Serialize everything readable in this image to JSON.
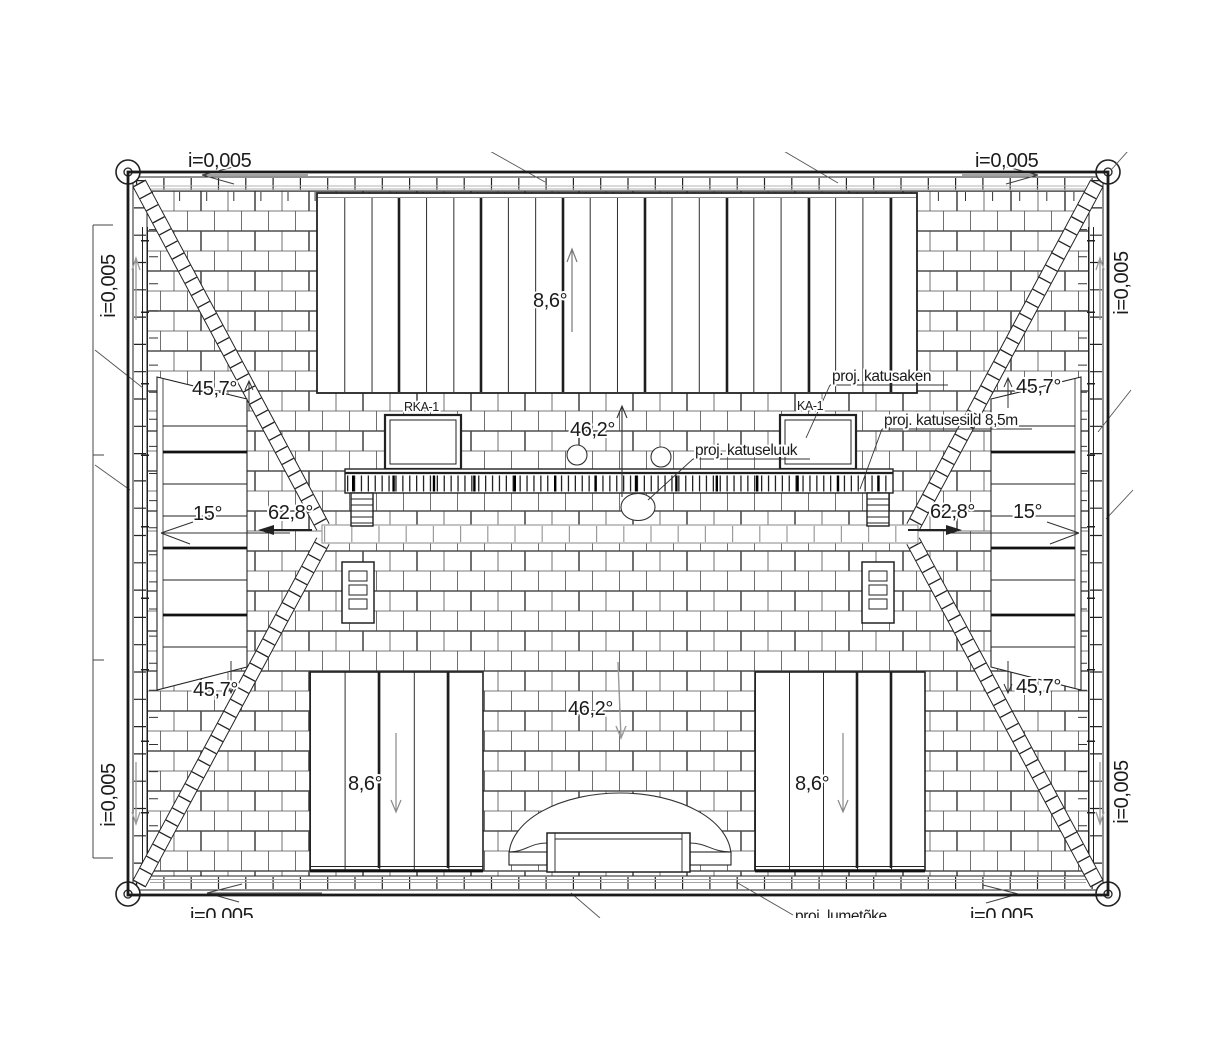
{
  "labels": {
    "eaves": {
      "top_left": "i=0,005",
      "top_right": "i=0,005",
      "bottom_left": "i=0,005",
      "bottom_right": "i=0,005",
      "left_top": "i=0,005",
      "left_bottom": "i=0,005",
      "right_top": "i=0,005",
      "right_bottom": "i=0,005"
    },
    "angles": {
      "main_slope_upper": "46,2°",
      "main_slope_lower": "46,2°",
      "top_dormer": "8,6°",
      "bottom_dormer_left": "8,6°",
      "bottom_dormer_right": "8,6°",
      "side_roof_left": "15°",
      "side_roof_right": "15°",
      "hip_slope_left": "62,8°",
      "hip_slope_right": "62,8°",
      "corner_top_left": "45,7°",
      "corner_top_right": "45,7°",
      "corner_bottom_left": "45,7°",
      "corner_bottom_right": "45,7°"
    },
    "skylight_left": "RKA-1",
    "skylight_right": "KA-1",
    "callouts": {
      "roof_window": "proj. katusaken",
      "roof_hatch": "proj. katuseluuk",
      "roof_bridge": "proj. katusesild 8,5m",
      "snow_guard": "proj. lumetõke"
    }
  },
  "colors": {
    "ink": "#1b1b1b",
    "ridge_gray": "#9b9b9b",
    "background": "#ffffff"
  }
}
